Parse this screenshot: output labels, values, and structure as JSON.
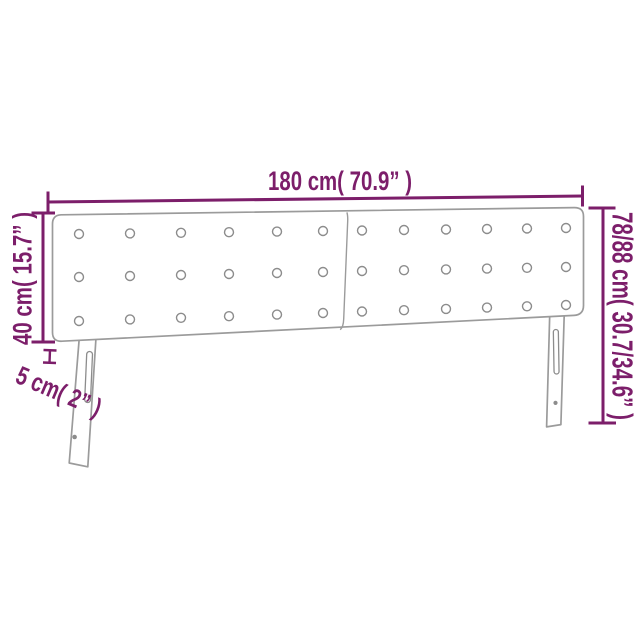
{
  "page": {
    "background": "#ffffff",
    "description": "Product dimension diagram of a two-panel tufted headboard with two slotted legs"
  },
  "colors": {
    "accent": "#7c1e6a",
    "outline": "#9b9b9b",
    "detail": "#8c8c8c",
    "background": "#ffffff"
  },
  "diagram": {
    "object": "headboard",
    "panels": 2,
    "legs": 2,
    "tufting_buttons": {
      "rows_per_panel": 3,
      "columns_per_panel": 6,
      "total": 36
    },
    "dimensions": {
      "width": {
        "label": "180 cm( 70.9” )",
        "value_cm": 180,
        "value_in": 70.9
      },
      "panel_height": {
        "label": "40 cm( 15.7” )",
        "value_cm": 40,
        "value_in": 15.7
      },
      "depth": {
        "label": "5 cm( 2” )",
        "value_cm": 5,
        "value_in": 2
      },
      "total_height": {
        "label": "78/88 cm( 30.7/34.6” )",
        "value_cm": "78/88",
        "value_in": "30.7/34.6"
      }
    }
  }
}
